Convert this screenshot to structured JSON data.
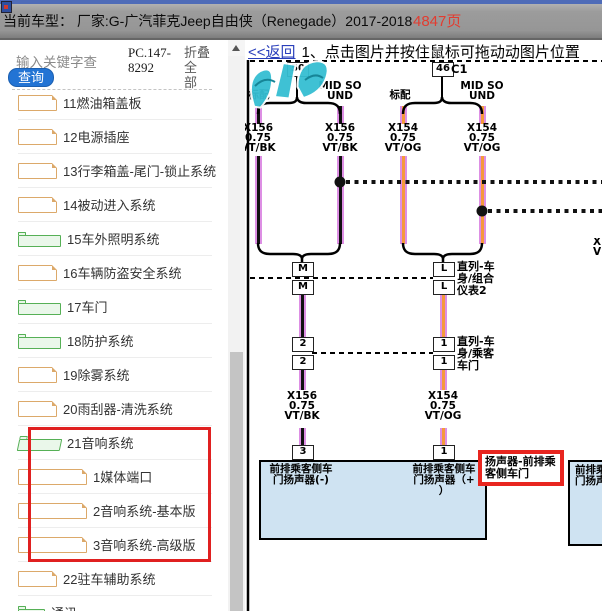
{
  "titlebar": {
    "vehicle_label": "当前车型：",
    "vehicle_value": "厂家:G-广汽菲克Jeep自由侠（Renegade）2017-2018",
    "page_count": "4847页"
  },
  "sidebar": {
    "search_placeholder": "输入关键字查",
    "pc_code": "PC.147-\n8292",
    "collapse_label": "折叠全\n部",
    "query_button": "查询",
    "items": [
      {
        "label": "11燃油箱盖板",
        "icon": "file",
        "level": 1
      },
      {
        "label": "12电源插座",
        "icon": "file",
        "level": 1
      },
      {
        "label": "13行李箱盖-尾门-锁止系统",
        "icon": "file",
        "level": 1
      },
      {
        "label": "14被动进入系统",
        "icon": "file",
        "level": 1
      },
      {
        "label": "15车外照明系统",
        "icon": "folder",
        "level": 1
      },
      {
        "label": "16车辆防盗安全系统",
        "icon": "file",
        "level": 1
      },
      {
        "label": "17车门",
        "icon": "folder",
        "level": 1
      },
      {
        "label": "18防护系统",
        "icon": "folder",
        "level": 1
      },
      {
        "label": "19除雾系统",
        "icon": "file",
        "level": 1
      },
      {
        "label": "20雨刮器-清洗系统",
        "icon": "file",
        "level": 1
      },
      {
        "label": "21音响系统",
        "icon": "folder-open",
        "level": 1,
        "highlighted": true
      },
      {
        "label": "1媒体端口",
        "icon": "file",
        "level": 2,
        "highlighted": true
      },
      {
        "label": "2音响系统-基本版",
        "icon": "file",
        "level": 2,
        "highlighted": true
      },
      {
        "label": "3音响系统-高级版",
        "icon": "file",
        "level": 2,
        "highlighted": true
      },
      {
        "label": "22驻车辅助系统",
        "icon": "file",
        "level": 1
      },
      {
        "label": "通讯",
        "icon": "folder",
        "level": 0,
        "partial": true
      }
    ]
  },
  "main": {
    "back_link": "<<返回",
    "instruction": "1、点击图片并按住鼠标可拖动动图片位置"
  },
  "diagram": {
    "connector": "C1",
    "pin_50": "50",
    "pin_46": "46",
    "branches": {
      "b1": "标配",
      "b2": "MID SO\nUND",
      "b3": "标配",
      "b4": "MID SO\nUND"
    },
    "wire_labels": {
      "w1": "X156\n0.75\nVT/BK",
      "w2": "X156\n0.75\nVT/BK",
      "w3": "X154\n0.75\nVT/OG",
      "w4": "X154\n0.75\nVT/OG",
      "w5": "X156\n0.75\nVT/BK",
      "w6": "X154\n0.75\nVT/OG",
      "edge_partial": "X\nV"
    },
    "inline_connectors": {
      "m_top": "M",
      "m_bottom": "M",
      "l_top": "L",
      "l_bottom": "L",
      "label_l": "直列-车\n身/组合\n仪表2",
      "p2_top": "2",
      "p2_bottom": "2",
      "p1_top": "1",
      "p1_bottom": "1",
      "label_p1": "直列-车\n身/乘客\n车门"
    },
    "bottom_pins": {
      "p3": "3",
      "p1": "1"
    },
    "component": {
      "pin_neg": "前排乘客侧车\n门扬声器(-)",
      "pin_pos": "前排乘客侧车\n门扬声器（+\n）",
      "name_tag": "扬声器-前排乘\n客侧车门",
      "partial_right": "前排乘客\n门扬声器"
    }
  },
  "colors": {
    "accent_blue": "#2374d4",
    "link_blue": "#2a3fbb",
    "highlight_red": "#e02020",
    "page_red": "#e23c30",
    "wire_violet": "#dd8fe4",
    "wire_orange": "#f59a3c",
    "component_fill": "#cfe3f2",
    "folder_green": "#56b056",
    "file_orange": "#dca96a",
    "watermark_cyan": "#35bed2"
  }
}
